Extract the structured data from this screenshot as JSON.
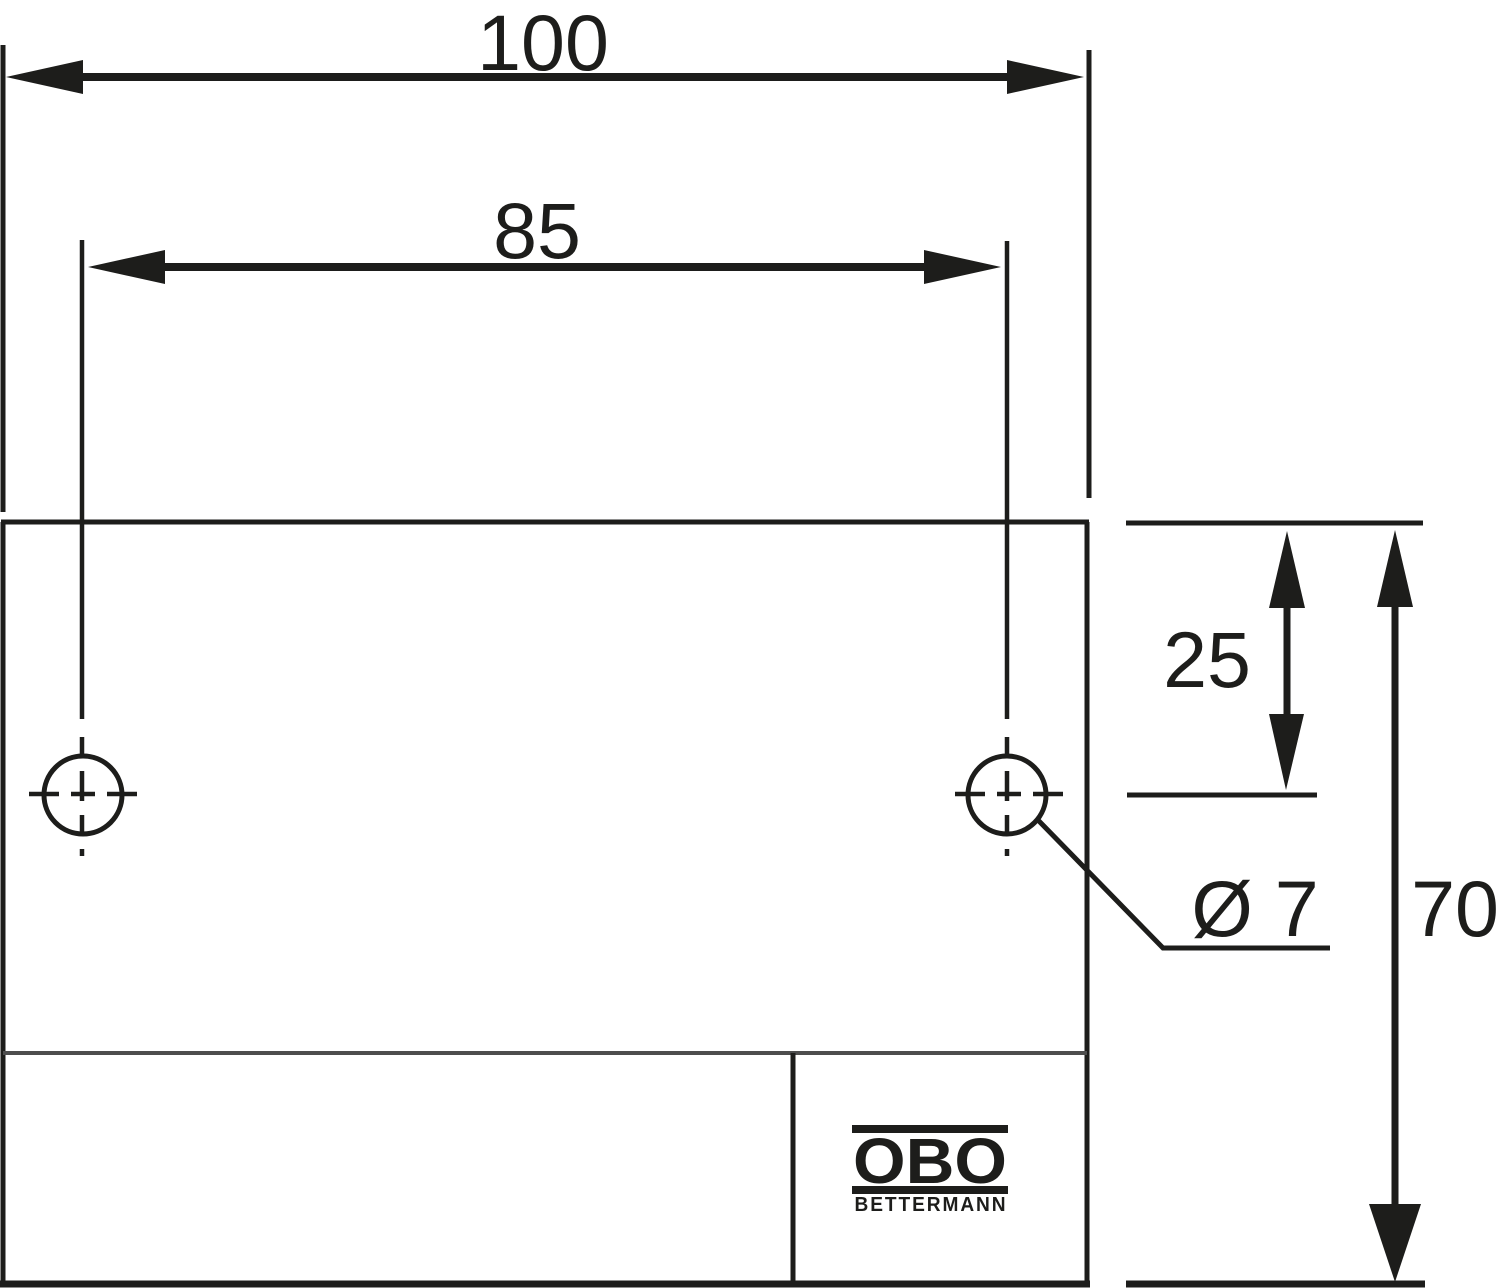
{
  "colors": {
    "line": "#1d1d1b",
    "divider_line": "#4d4d4d",
    "background": "#ffffff"
  },
  "dimension_labels": {
    "overall_width": "100",
    "hole_spacing": "85",
    "hole_vertical_offset": "25",
    "overall_height": "70",
    "hole_diameter": "Ø 7"
  },
  "logo": {
    "brand": "OBO",
    "subbrand": "BETTERMANN"
  }
}
